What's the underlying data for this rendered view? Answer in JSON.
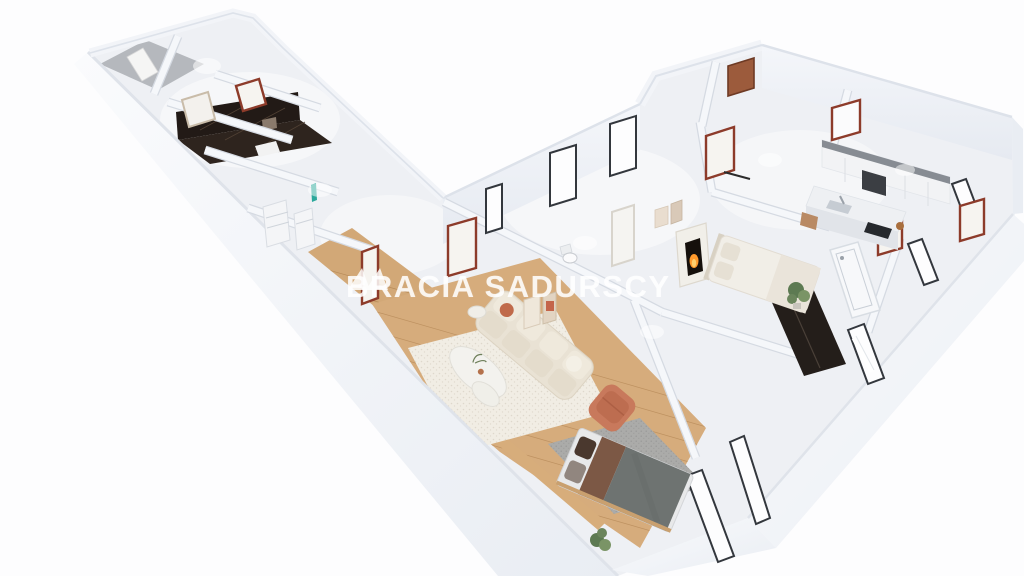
{
  "page": {
    "background_color": "#fdfdfe",
    "content_type": "3d-apartment-floorplan-render"
  },
  "watermark": {
    "brand_word_1": "BRACIA",
    "brand_word_2": "SADURSCY",
    "logo_icon": "twin-mountain-triangles-icon",
    "text_color": "#ffffff",
    "opacity": 0.84
  },
  "palette": {
    "wall_white": "#f3f5f8",
    "wall_shadow": "#dfe3ea",
    "floor_light": "#eef0f4",
    "floor_gray": "#b5b8bd",
    "wood_floor": "#d6ac7c",
    "wood_hall": "#d2a877",
    "dark_marble": "#241c17",
    "mahogany_door": "#8d3b2a",
    "window_frame": "#33373d",
    "sofa_beige": "#e9e2d4",
    "rug_cream": "#f1ede4",
    "armchair_terracotta": "#c8795c",
    "bed_blanket_gray": "#6e7371",
    "bed_blanket_brown": "#7c5845",
    "fire_glow": "#ff9a2c",
    "kitchen_accent_gray": "#878c93",
    "teal_accent": "#2ba89b",
    "plant_green": "#5d7a52"
  },
  "scene": {
    "view": "cutaway-dollhouse-top-perspective",
    "rooms_visible": [
      "entry-hall",
      "dark-marble-bathroom",
      "utility-room",
      "hallway",
      "living-room",
      "bedroom-with-fireplace",
      "kitchen",
      "bathroom-with-bathtub",
      "lower-bedroom"
    ]
  }
}
